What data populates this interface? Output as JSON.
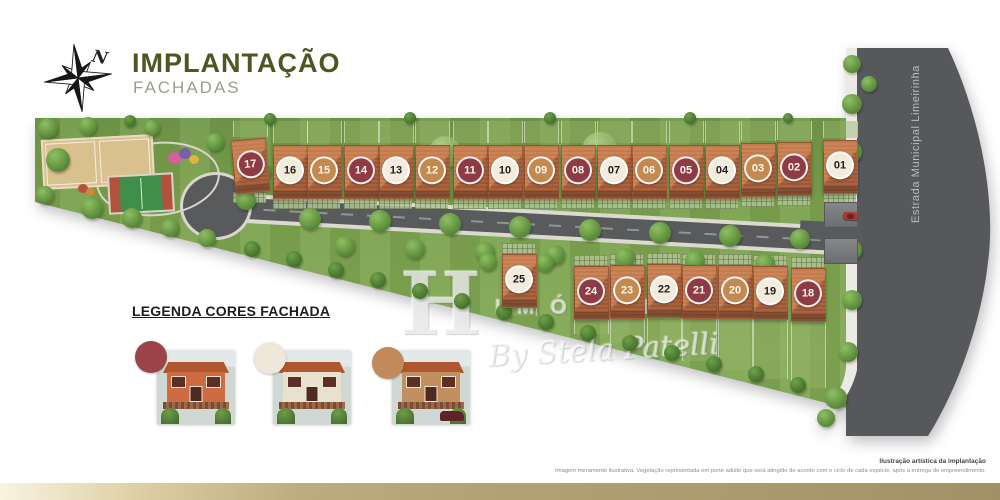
{
  "header": {
    "title": "IMPLANTAÇÃO",
    "subtitle": "FACHADAS",
    "compass_label": "N"
  },
  "colors": {
    "accent_olive": "#4c5822",
    "subtitle_gray_green": "#96a18c",
    "gold_bar_left": "#f9f3e0",
    "gold_bar_right": "#a29166",
    "road_gray": "#595a5c",
    "grass_green": "#7ba24e"
  },
  "site_plan": {
    "street_label": "Estrada Municipal Limeirinha",
    "facade_colors": {
      "red": "#8e3b46",
      "cream": "#f3ecdd",
      "tan": "#c3894f"
    },
    "houses_top_row": [
      {
        "lot": "17",
        "facade": "red"
      },
      {
        "lot": "16",
        "facade": "cream"
      },
      {
        "lot": "15",
        "facade": "tan"
      },
      {
        "lot": "14",
        "facade": "red"
      },
      {
        "lot": "13",
        "facade": "cream"
      },
      {
        "lot": "12",
        "facade": "tan"
      },
      {
        "lot": "11",
        "facade": "red"
      },
      {
        "lot": "10",
        "facade": "cream"
      },
      {
        "lot": "09",
        "facade": "tan"
      },
      {
        "lot": "08",
        "facade": "red"
      },
      {
        "lot": "07",
        "facade": "cream"
      },
      {
        "lot": "06",
        "facade": "tan"
      },
      {
        "lot": "05",
        "facade": "red"
      },
      {
        "lot": "04",
        "facade": "cream"
      },
      {
        "lot": "03",
        "facade": "tan"
      },
      {
        "lot": "02",
        "facade": "red"
      },
      {
        "lot": "01",
        "facade": "cream"
      }
    ],
    "houses_bottom_row": [
      {
        "lot": "25",
        "facade": "cream"
      },
      {
        "lot": "24",
        "facade": "red"
      },
      {
        "lot": "23",
        "facade": "tan"
      },
      {
        "lot": "22",
        "facade": "cream"
      },
      {
        "lot": "21",
        "facade": "red"
      },
      {
        "lot": "20",
        "facade": "tan"
      },
      {
        "lot": "19",
        "facade": "cream"
      },
      {
        "lot": "18",
        "facade": "red"
      }
    ]
  },
  "legend": {
    "title": "LEGENDA CORES FACHADA",
    "items": [
      {
        "swatch": "#9a4449",
        "wall": "#cf6b42"
      },
      {
        "swatch": "#efe8da",
        "wall": "#e8e1d0"
      },
      {
        "swatch": "#c28a5a",
        "wall": "#c28f60"
      }
    ]
  },
  "watermark": {
    "brand_initial": "H",
    "brand_word": "IMÓVEIS",
    "brand_script": "By Stela Patelli"
  },
  "footer": {
    "credit": "Ilustração artística da implantação",
    "disclaimer": "Imagem meramente ilustrativa. Vegetação representada em porte adulto que será atingido de acordo com o ciclo de cada espécie, após a entrega do empreendimento."
  }
}
